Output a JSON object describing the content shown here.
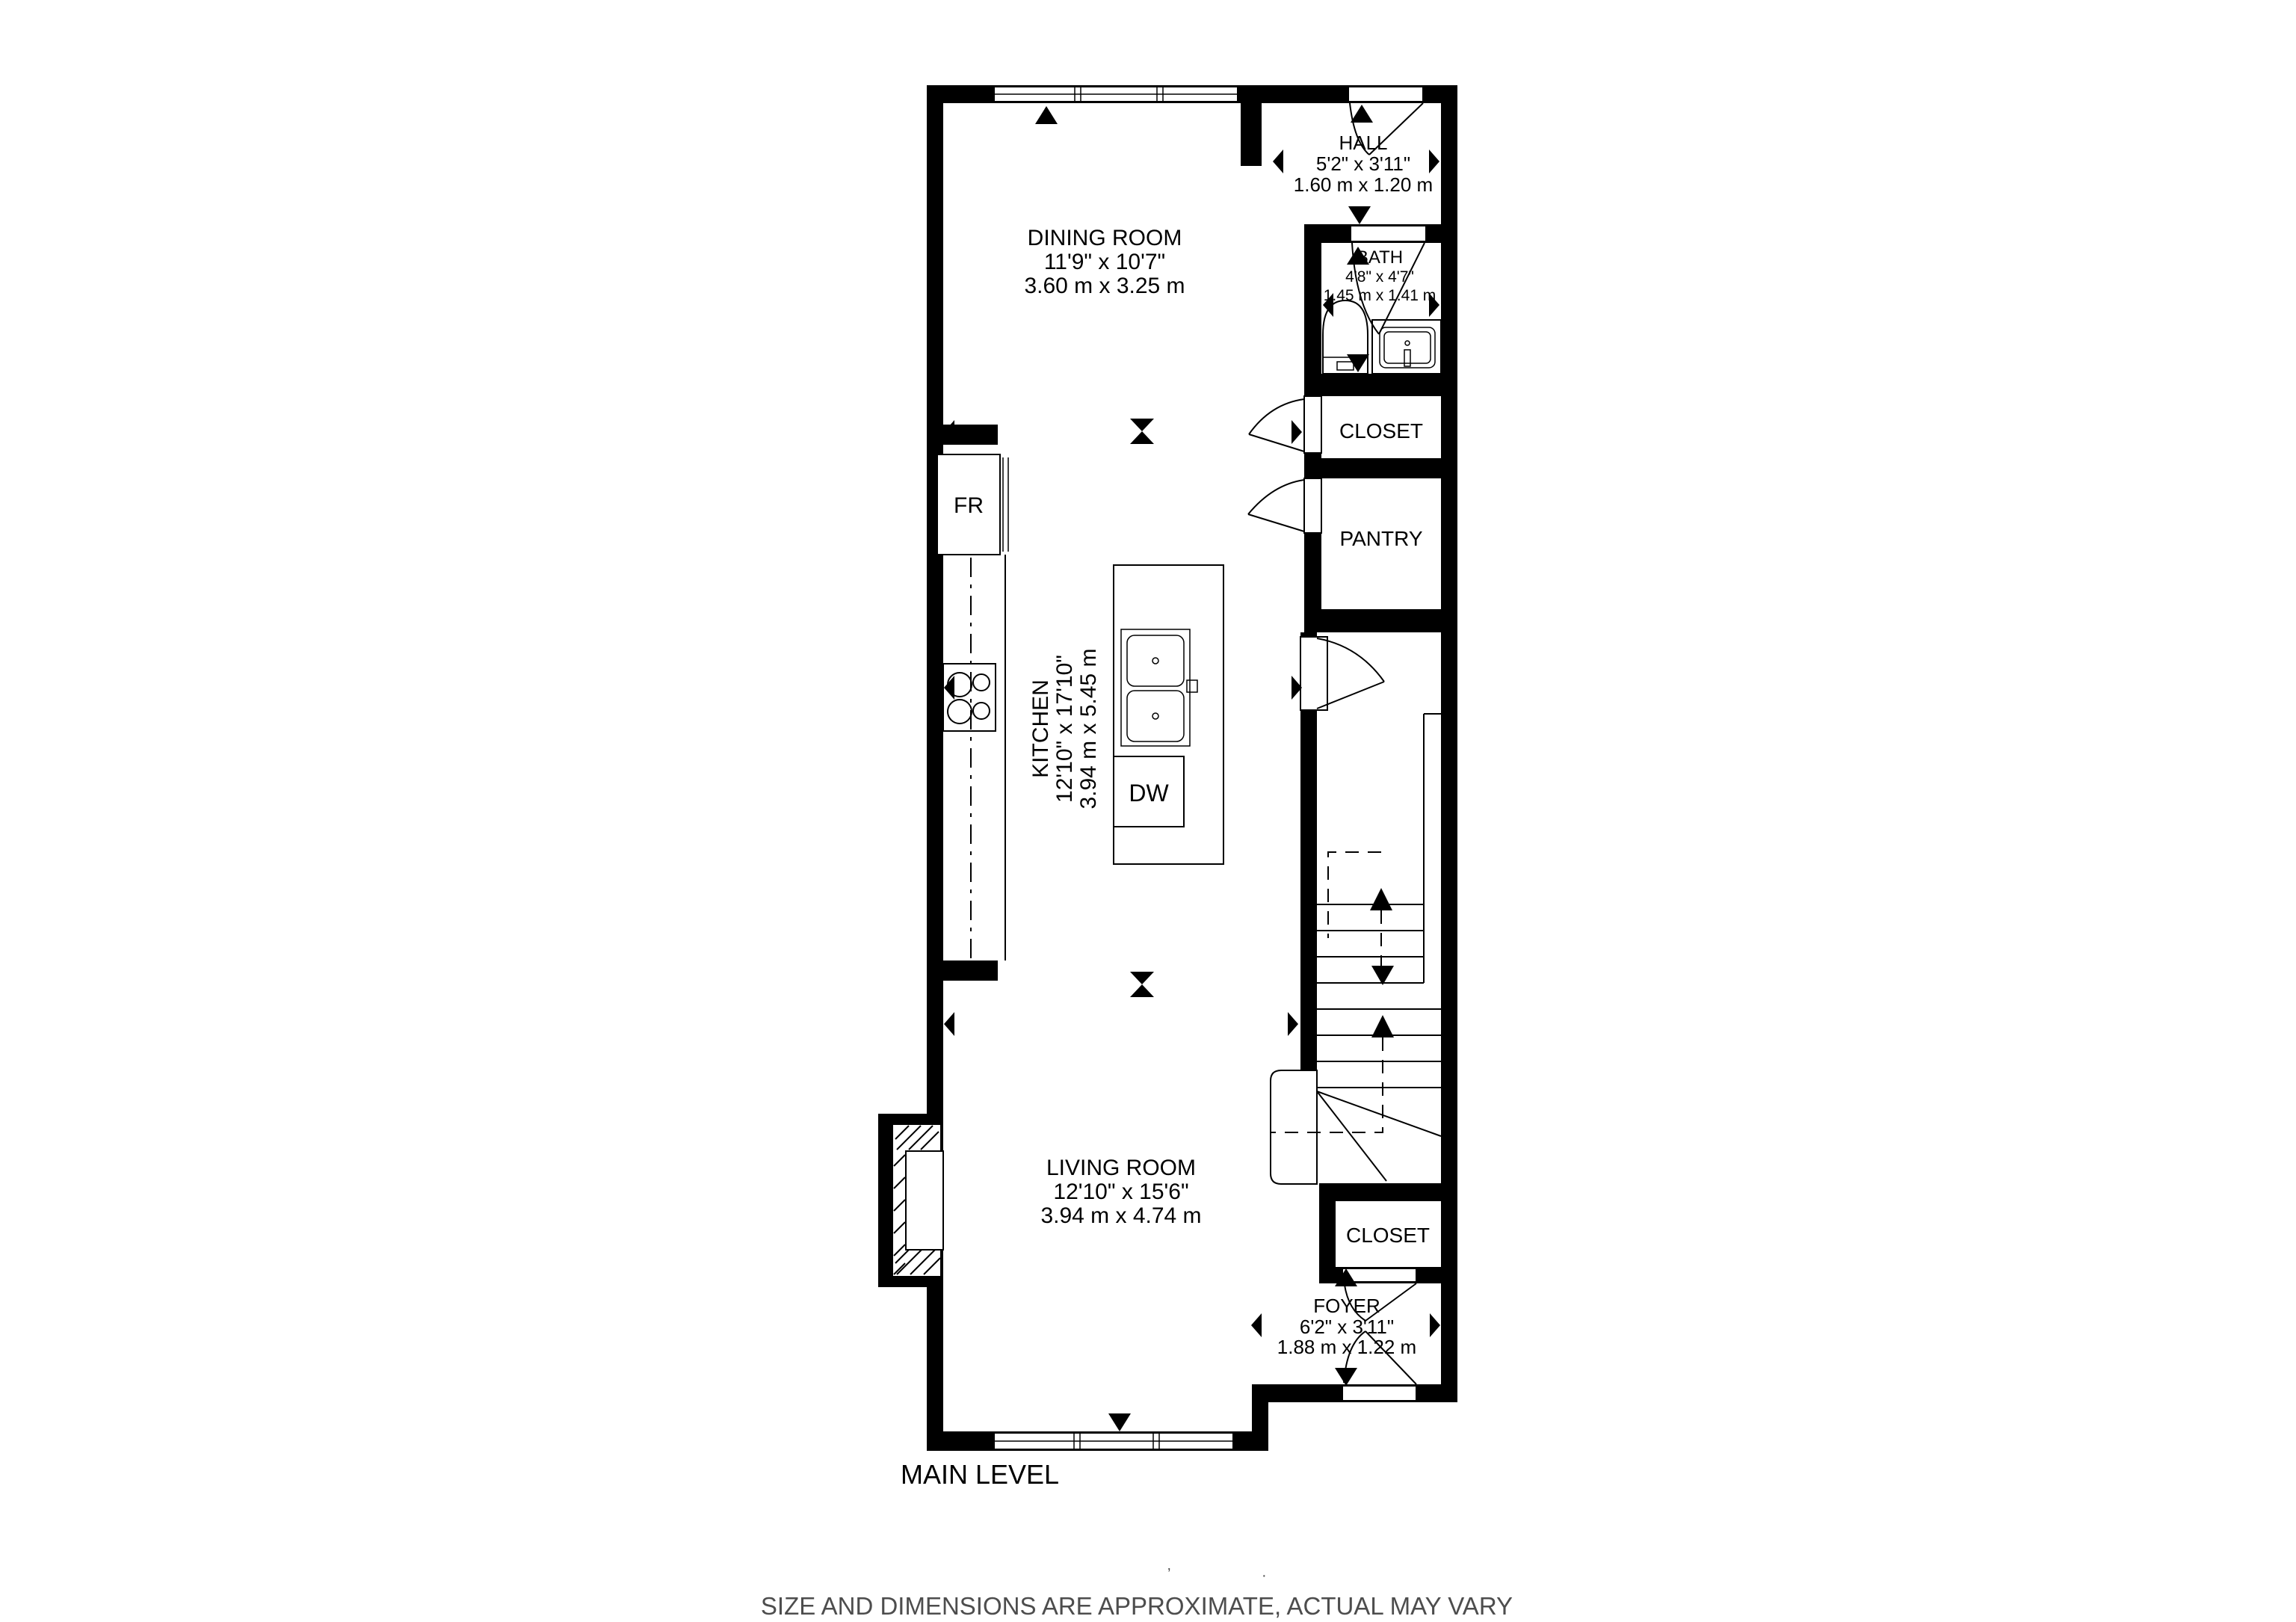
{
  "page": {
    "level_label": "MAIN LEVEL",
    "disclaimer": "SIZE AND DIMENSIONS ARE APPROXIMATE, ACTUAL MAY VARY",
    "stray_marks": {
      "tick": "’",
      "dot": "·"
    },
    "colors": {
      "walls": "#000000",
      "background": "#ffffff",
      "disclaimer_text": "#4d4d4d"
    }
  },
  "rooms": {
    "dining_room": {
      "name": "DINING ROOM",
      "dims_imperial": "11'9\" x 10'7\"",
      "dims_metric": "3.60 m x 3.25 m"
    },
    "kitchen": {
      "name": "KITCHEN",
      "dims_imperial": "12'10\" x 17'10\"",
      "dims_metric": "3.94 m x 5.45 m"
    },
    "living_room": {
      "name": "LIVING ROOM",
      "dims_imperial": "12'10\" x 15'6\"",
      "dims_metric": "3.94 m x 4.74 m"
    },
    "hall": {
      "name": "HALL",
      "dims_imperial": "5'2\" x 3'11\"",
      "dims_metric": "1.60 m x 1.20 m"
    },
    "bath": {
      "name": "BATH",
      "dims_imperial": "4'8\" x 4'7\"",
      "dims_metric": "1.45 m x 1.41 m"
    },
    "foyer": {
      "name": "FOYER",
      "dims_imperial": "6'2\" x 3'11\"",
      "dims_metric": "1.88 m x 1.22 m"
    },
    "closet_upper": {
      "name": "CLOSET"
    },
    "pantry": {
      "name": "PANTRY"
    },
    "closet_lower": {
      "name": "CLOSET"
    }
  },
  "appliances": {
    "refrigerator": "FR",
    "dishwasher": "DW"
  }
}
